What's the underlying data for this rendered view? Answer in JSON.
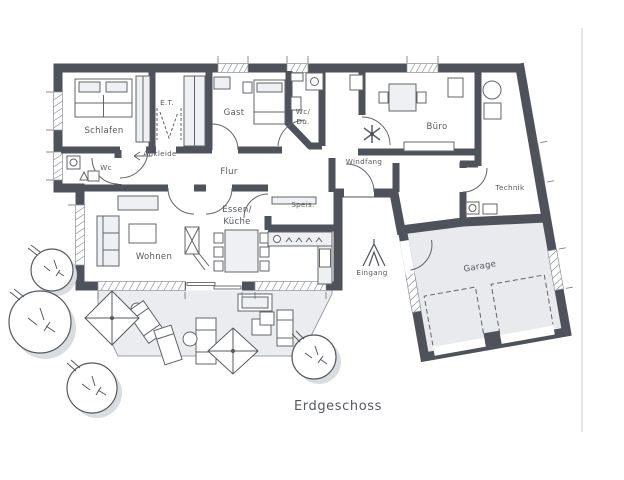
{
  "plan": {
    "title": "Erdgeschoss",
    "type": "floor-plan",
    "colors": {
      "wall": "#4e525a",
      "floor": "#ffffff",
      "garage_floor": "#e8eaee",
      "terrace": "#eaecef",
      "furniture_fill": "#eef0f3",
      "line": "#60646a",
      "label": "#54585e"
    }
  },
  "rooms": {
    "schlafen": "Schlafen",
    "ankleide": "Ankleide",
    "et": "E.T.",
    "gast": "Gast",
    "wc_du_line1": "Wc/",
    "wc_du_line2": "Du.",
    "wc": "Wc",
    "flur": "Flur",
    "windfang": "Windfang",
    "buero": "Büro",
    "technik": "Technik",
    "wohnen": "Wohnen",
    "essen_line1": "Essen/",
    "essen_line2": "Küche",
    "speis": "Speis.",
    "eingang": "Eingang",
    "garage": "Garage"
  }
}
